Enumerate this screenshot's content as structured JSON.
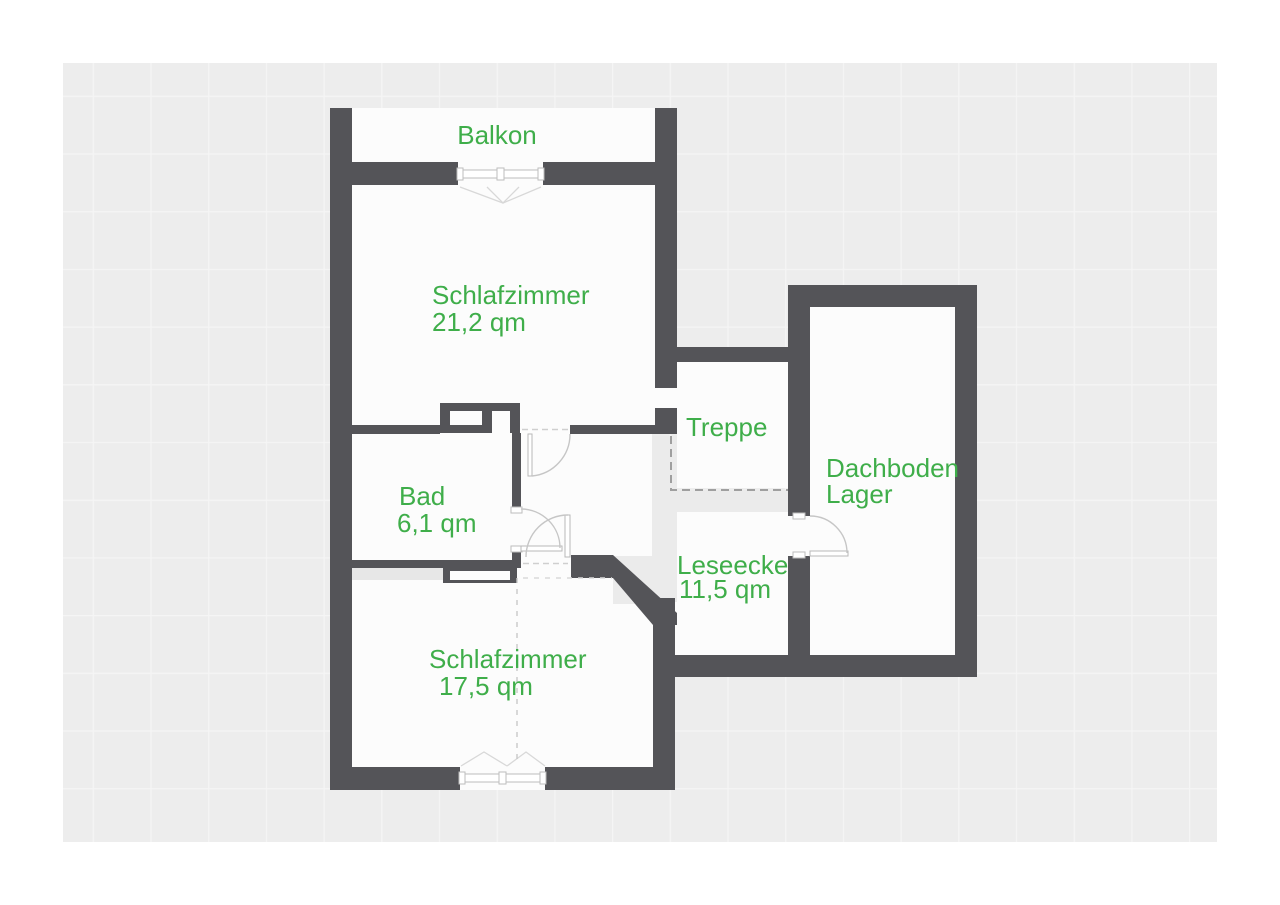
{
  "floorplan": {
    "rooms": {
      "balkon": {
        "label": "Balkon"
      },
      "schlafzimmer_nord": {
        "label": "Schlafzimmer",
        "area": "21,2 qm"
      },
      "bad": {
        "label": "Bad",
        "area": "6,1 qm"
      },
      "treppe": {
        "label": "Treppe"
      },
      "leseecke": {
        "label": "Leseecke",
        "area": "11,5 qm"
      },
      "schlafzimmer_sued": {
        "label": "Schlafzimmer",
        "area": "17,5 qm"
      },
      "dachboden": {
        "label_line1": "Dachboden",
        "label_line2": "Lager"
      }
    },
    "colors": {
      "label_green": "#3FAE4A",
      "wall_gray": "#545458",
      "canvas_gray": "#EDEDED",
      "floor_white": "#FCFCFC"
    }
  }
}
